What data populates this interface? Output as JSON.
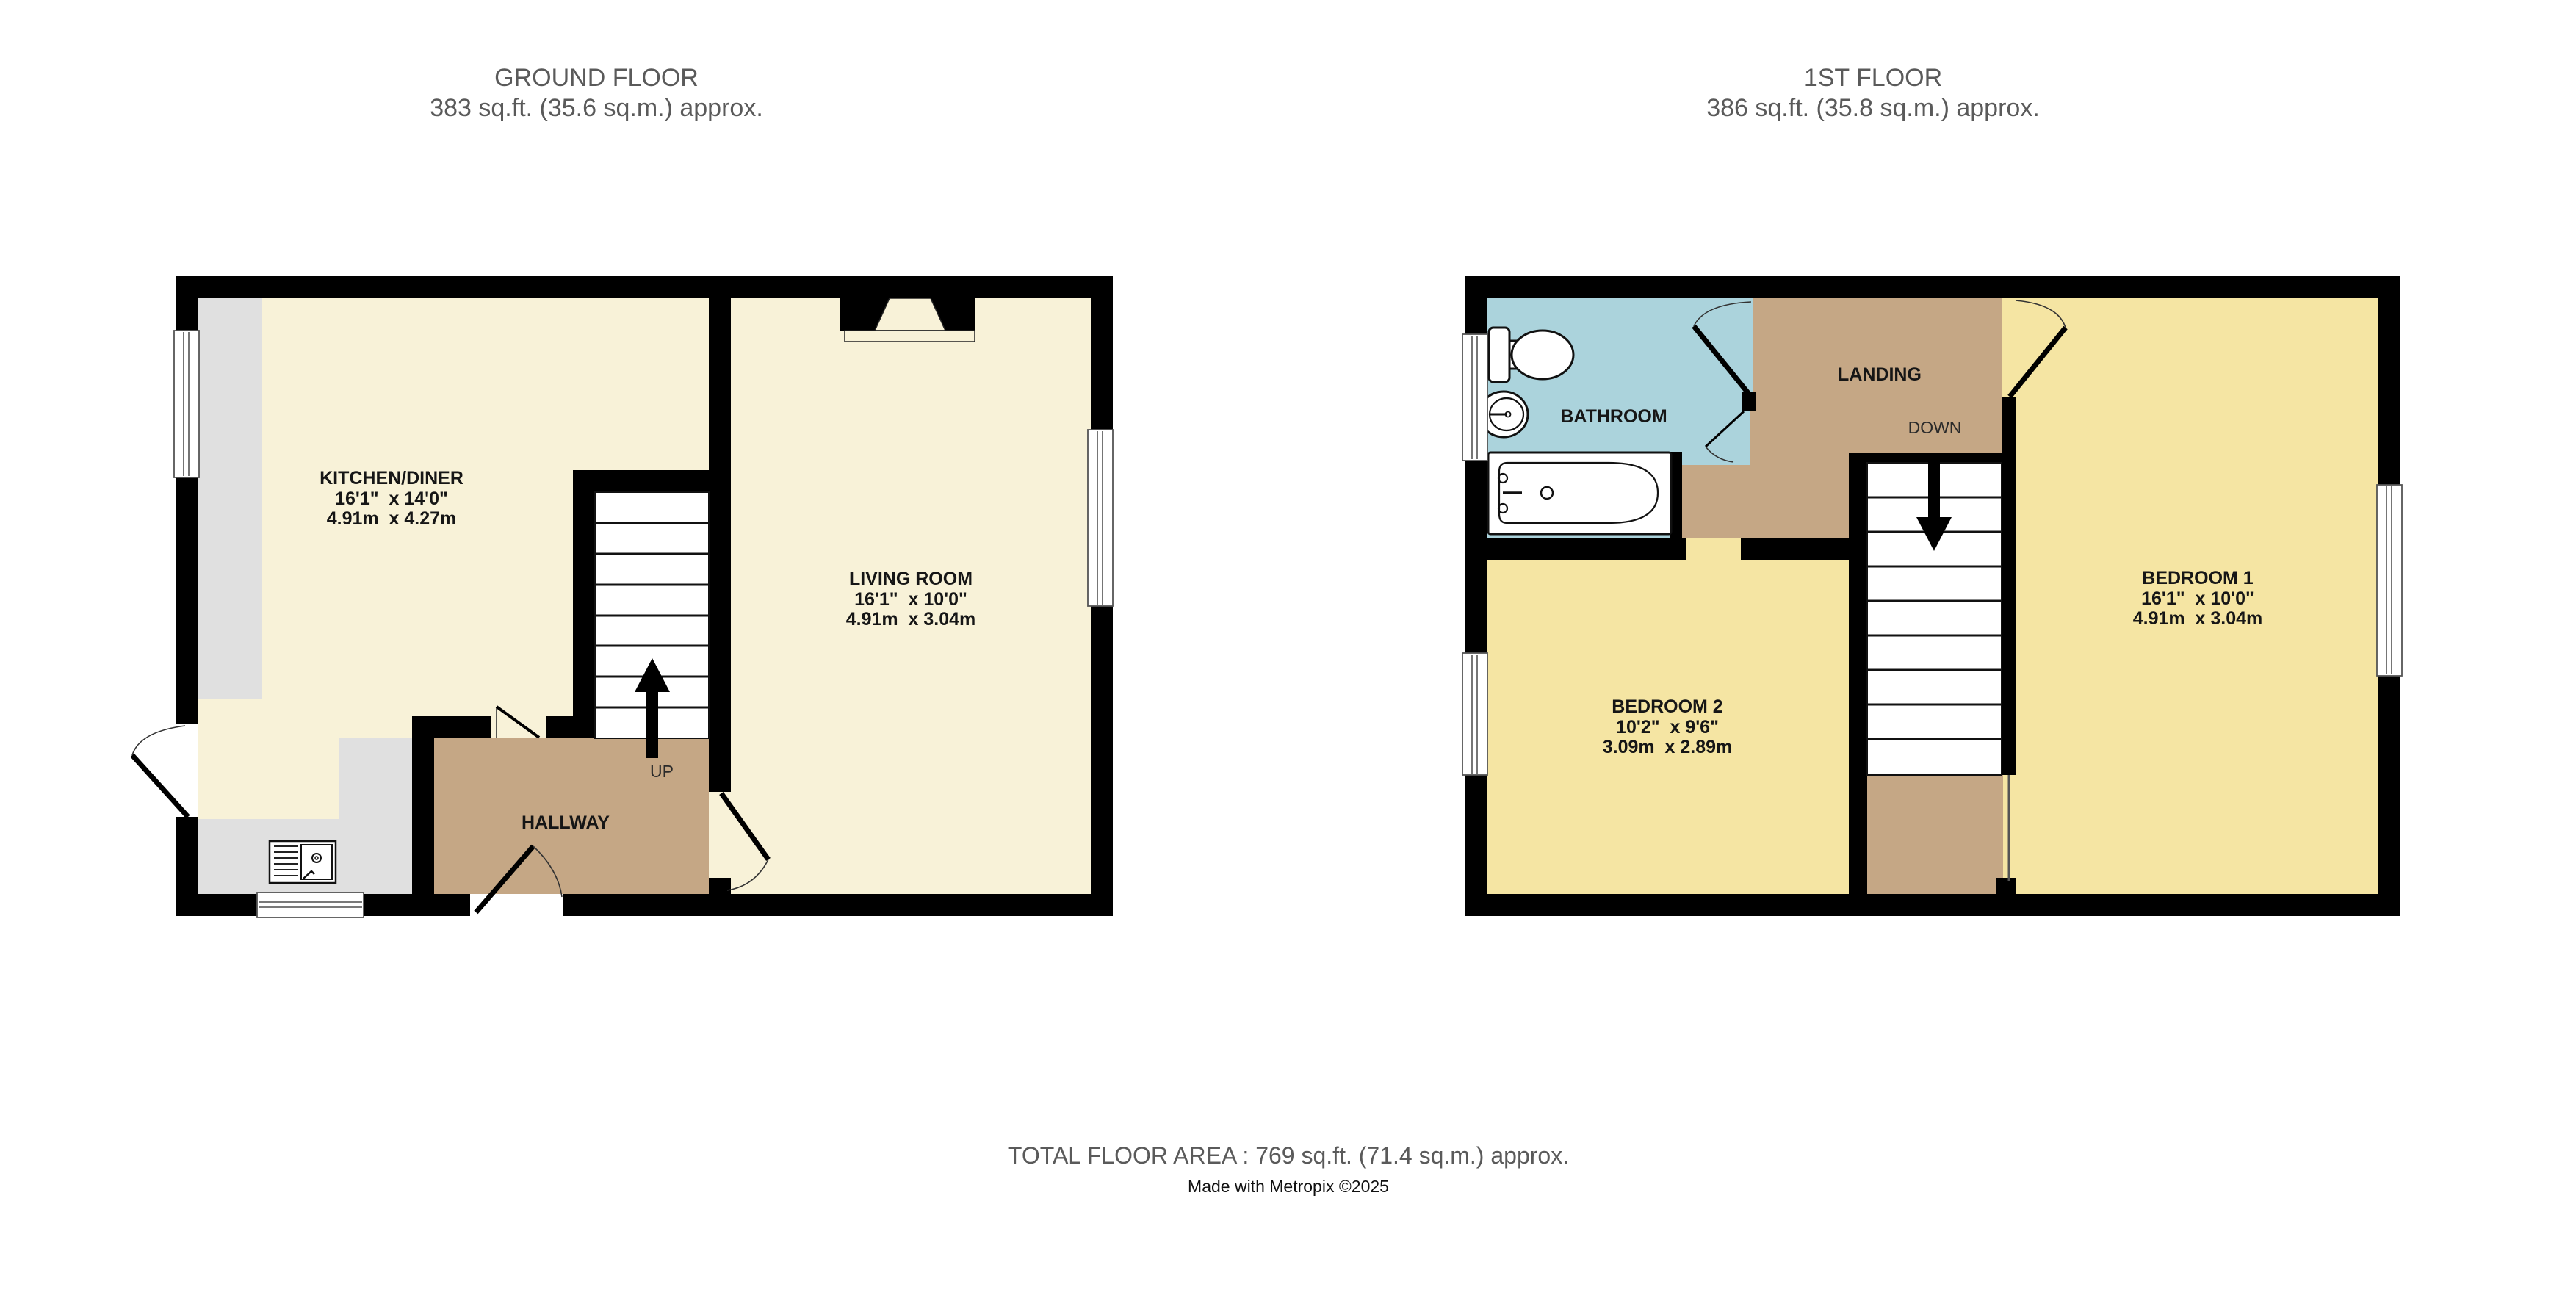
{
  "colors": {
    "wall": "#000000",
    "kitchen_living_cream": "#f8f2d8",
    "bedroom_yellow": "#f5e5a3",
    "hall_landing_tan": "#c5a785",
    "bathroom_blue": "#abd3dc",
    "counter_gray": "#e0e0e0",
    "title_gray": "#5a5a5a"
  },
  "floors": {
    "ground": {
      "title": "GROUND FLOOR",
      "area": "383 sq.ft. (35.6 sq.m.) approx."
    },
    "first": {
      "title": "1ST FLOOR",
      "area": "386 sq.ft. (35.8 sq.m.) approx."
    }
  },
  "rooms": {
    "kitchen": {
      "name": "KITCHEN/DINER",
      "imperial": "16'1\"  x 14'0\"",
      "metric": "4.91m  x 4.27m"
    },
    "living": {
      "name": "LIVING ROOM",
      "imperial": "16'1\"  x 10'0\"",
      "metric": "4.91m  x 3.04m"
    },
    "hallway": {
      "name": "HALLWAY"
    },
    "bathroom": {
      "name": "BATHROOM"
    },
    "landing": {
      "name": "LANDING"
    },
    "bedroom1": {
      "name": "BEDROOM 1",
      "imperial": "16'1\"  x 10'0\"",
      "metric": "4.91m  x 3.04m"
    },
    "bedroom2": {
      "name": "BEDROOM 2",
      "imperial": "10'2\"  x 9'6\"",
      "metric": "3.09m  x 2.89m"
    }
  },
  "stairs": {
    "up": "UP",
    "down": "DOWN"
  },
  "footer": {
    "total": "TOTAL FLOOR AREA : 769 sq.ft. (71.4 sq.m.) approx.",
    "credit": "Made with Metropix ©2025"
  }
}
